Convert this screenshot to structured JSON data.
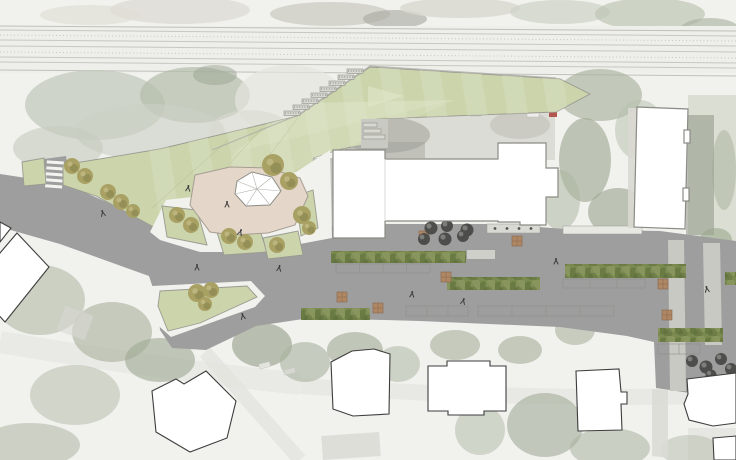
{
  "canvas": {
    "width": 736,
    "height": 460
  },
  "scene": {
    "kind": "landscape-architecture site plan collaged over faded aerial photograph",
    "visible_text": ""
  },
  "colors": {
    "aerial_base": "#f1f1ee",
    "railway_band": "#eeeeea",
    "railway_line": "#c8c8c1",
    "road": "#9e9e9e",
    "road_light_strip": "#c9c9c3",
    "path_white": "#f1f1ed",
    "lawn": "#cbd4ab",
    "lawn_stripe": "#d8dfc0",
    "lawn_pale": "#e1e6cb",
    "lawn_edge": "#9a9a92",
    "plaza": "#e4d6c9",
    "plaza_edge": "#a69d92",
    "hedge": "#7b8a4f",
    "hedge_dark": "#657540",
    "hedge_light": "#93a067",
    "tree_olive": "#a9a164",
    "tree_olive_dark": "#7f7c49",
    "tree_olive_light": "#c2ba85",
    "tree_dark": "#4d4d4b",
    "tree_dark_light": "#8a8a86",
    "seat": "#ae8765",
    "seat_line": "#8a674c",
    "building_fill": "#ffffff",
    "building_new_edge": "#8b8b85",
    "building_old_edge": "#3d3d3c",
    "stair": "#d8d8d2",
    "stair_edge": "#8f8f88",
    "person": "#3c3c3c",
    "canopy": "#d9d9d3",
    "car_red": "#b2574d"
  },
  "symbols": {
    "pavilion": "faceted white canopy pavilion on plaza",
    "dark_circle": "new plaza tree",
    "olive_circle": "existing park tree",
    "green_row": "street hedge / shrub band",
    "brown_square": "timber seating cube",
    "striped_band": "pedestrian crossing",
    "stepped_edge": "lawn terrace stairs"
  }
}
